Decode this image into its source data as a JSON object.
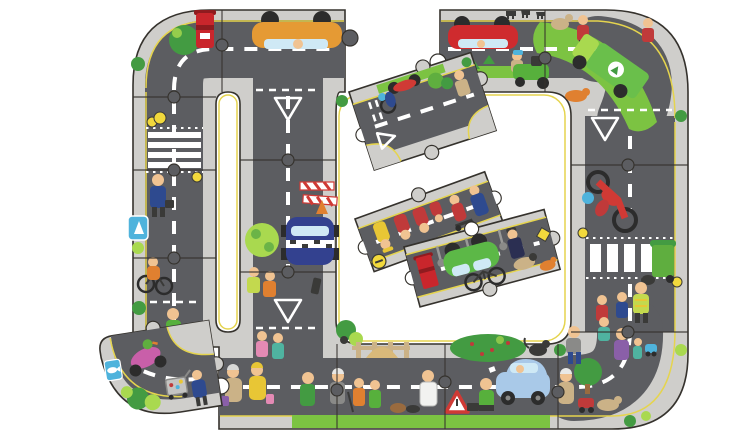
{
  "meta": {
    "description": "Giant road jigsaw puzzle product photo: road pieces assembled into a large loop with a missing top piece and missing bottom-left corner, and four detached road pieces lying inside and below the loop, on a plain white background",
    "background": "#ffffff",
    "canvas": {
      "width": 750,
      "height": 440
    }
  },
  "colors": {
    "bg": "#ffffff",
    "road": "#5c5d61",
    "walk": "#cfcecb",
    "curb": "#e5d44e",
    "outline": "#35322d",
    "marking": "#ffffff",
    "grass": "#7cc342",
    "grassdk": "#439b42",
    "grasslt": "#a9d94f",
    "postbox": "#c9262c",
    "postboxdk": "#8f1b1f",
    "orangecar": "#e59a34",
    "redcar": "#cf2b2e",
    "bluecar": "#a9c9e8",
    "window": "#cfe9f5",
    "police": "#33418f",
    "truck": "#6abf4b",
    "moto": "#d03a35",
    "scooter": "#c95fa9",
    "bin": "#5fae3f",
    "cargreen": "#5cb847",
    "mower": "#57b03c",
    "signblue": "#4fb3dc",
    "signyellow": "#f2d93c",
    "skin": "#f0c392",
    "navy": "#2e4a8f",
    "red": "#c03a3a",
    "yellow": "#e8c635",
    "tan": "#cbb287",
    "sand": "#d9b97a",
    "gray": "#8a8a88",
    "dk": "#3a3a38",
    "wheel": "#2c2c2c",
    "pink": "#e48ab4",
    "teal": "#4fb3a0",
    "purple": "#8a5fa8",
    "brown": "#9a6b3f",
    "orange": "#e08030",
    "hivis": "#c3d94e"
  },
  "scene": {
    "subject": "giant road jigsaw puzzle",
    "assembled_sections": [
      "top-left corner with red postbox and tree",
      "left vertical road with zebra crossing and cyclist",
      "inner U-turn white slot",
      "middle vertical road with police car, roadworks and tree",
      "top road with upside-down orange car and red car (one piece missing)",
      "top-right corner with recycling truck, mower and farm animals",
      "right vertical road with motorbike, wheelie bin and zebra crossing",
      "bottom-right corner with tree, pram and dog",
      "bottom road with pedestrians, blue car, hedge and fence"
    ],
    "detached_pieces": [
      {
        "name": "t-junction piece with red motorbike, cyclist and give-way markings",
        "rotation_deg": -18
      },
      {
        "name": "straight road piece with firefighter, red figures, scooter rider and mechanic",
        "rotation_deg": -20
      },
      {
        "name": "straight road piece with upside-down green car, red postbox, bicycle, police officer and dog",
        "rotation_deg": -15
      },
      {
        "name": "curved corner piece with pink scooter, fish sign, bushes and shopping trolley",
        "rotation_deg": -9
      }
    ],
    "vehicles": [
      "orange car",
      "red car",
      "green recycling truck",
      "ride-on mower",
      "red motorbike",
      "police car",
      "light blue car",
      "green car",
      "pink scooter",
      "bicycle"
    ],
    "street_items": [
      "red postbox",
      "belisha beacons",
      "zebra crossings",
      "give-way triangles",
      "green wheelie bin",
      "roadworks barriers",
      "warning triangle sign",
      "street lamps",
      "wooden fence",
      "berry hedge",
      "trees",
      "bushes"
    ],
    "figures": [
      "businessman",
      "cyclist",
      "firefighter",
      "mechanic in blue overalls",
      "police officer",
      "postal workers in red",
      "workers in hi-vis",
      "children crossing",
      "old ladies with bags",
      "doctor in white coat",
      "farmer",
      "shopper with trolley",
      "dog",
      "cat",
      "farm animals"
    ]
  }
}
